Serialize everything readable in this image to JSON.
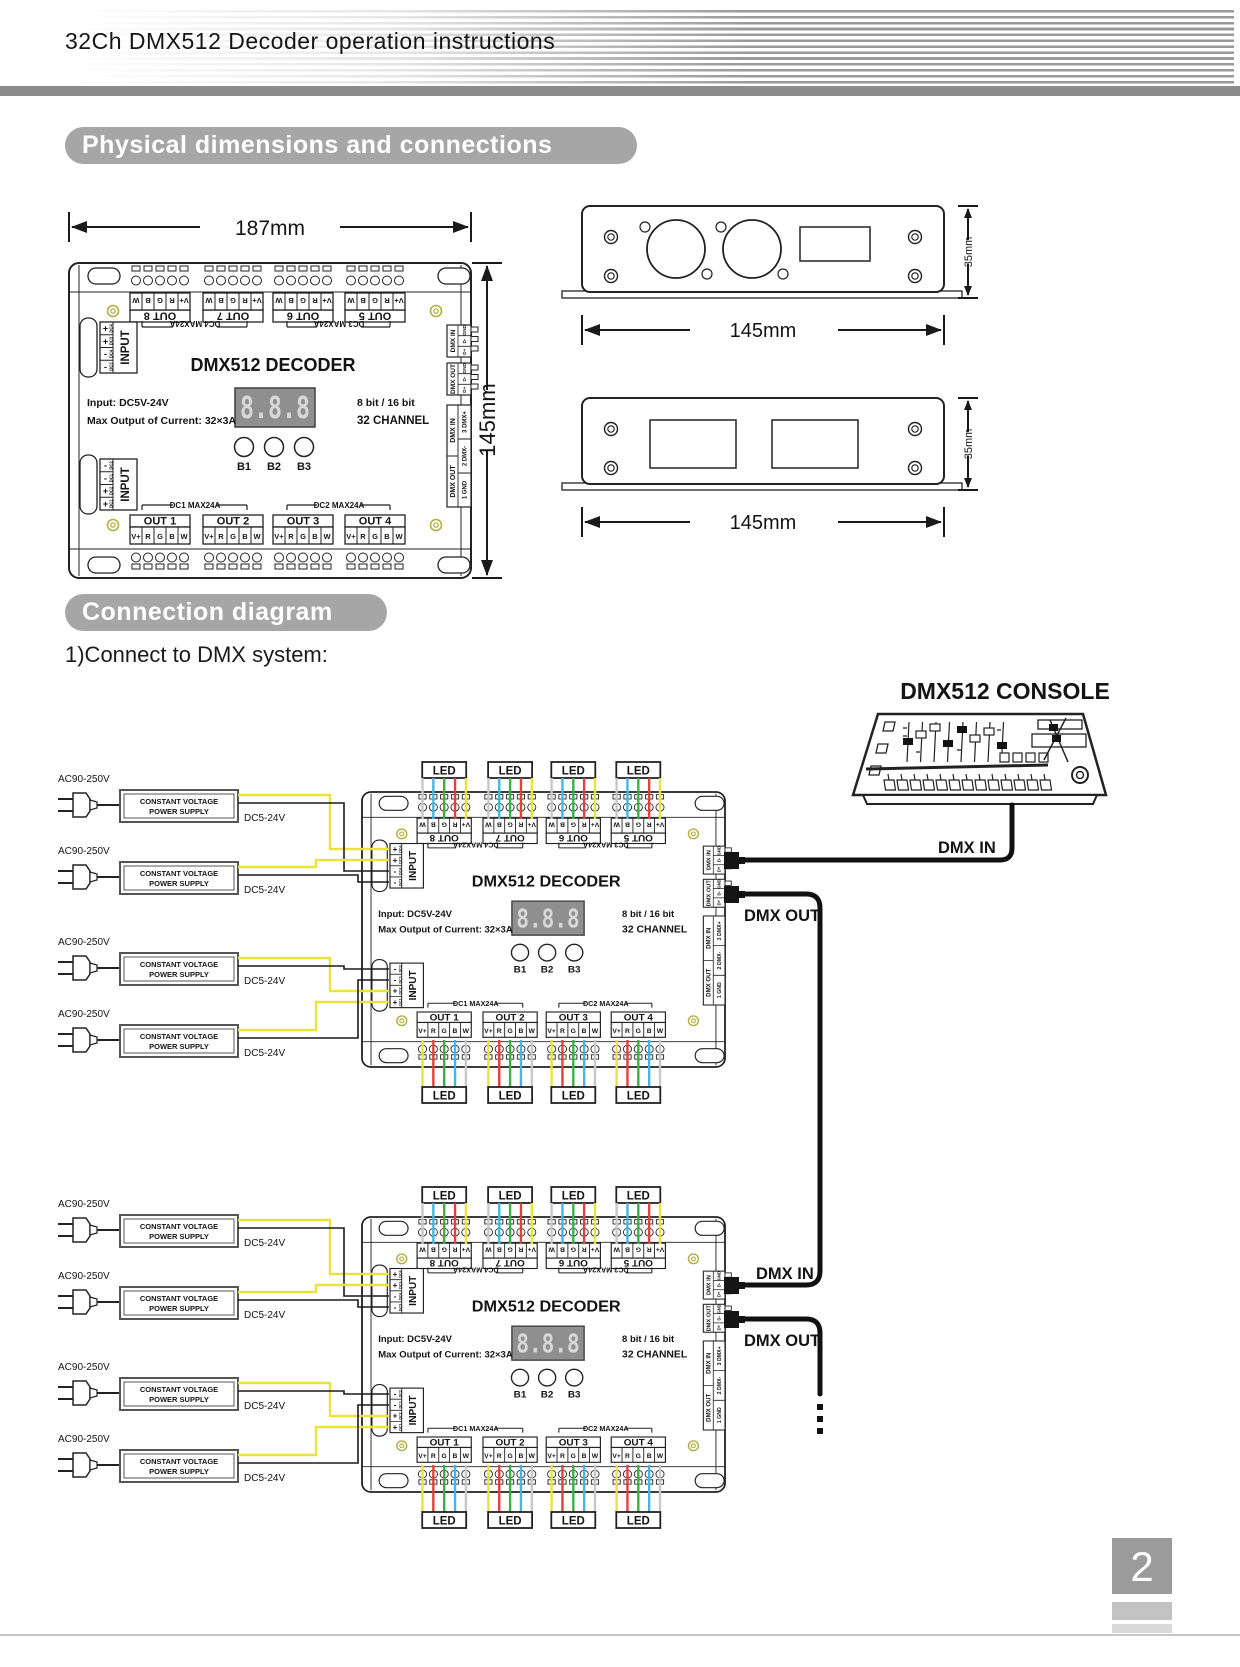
{
  "header": {
    "title": "32Ch DMX512 Decoder operation instructions"
  },
  "sections": {
    "physical": "Physical dimensions and connections",
    "connection": "Connection diagram",
    "step1": "1)Connect to DMX system:"
  },
  "footer": {
    "page_number": "2"
  },
  "dimensions": {
    "width": "187mm",
    "height": "145mm",
    "side_width": "145mm",
    "side_height": "35mm"
  },
  "decoder": {
    "title": "DMX512 DECODER",
    "display_value": "8.8.8",
    "input_spec": "Input: DC5V-24V",
    "output_spec": "Max Output of Current: 32×3A",
    "bit_mode": "8  bit / 16 bit",
    "channel_mode": "32  CHANNEL",
    "buttons": [
      "B1",
      "B2",
      "B3"
    ],
    "outs_top": [
      "OUT 8",
      "OUT 7",
      "OUT 6",
      "OUT 5"
    ],
    "outs_bottom": [
      "OUT 1",
      "OUT 2",
      "OUT 3",
      "OUT 4"
    ],
    "pins": [
      "V+",
      "R",
      "G",
      "B",
      "W"
    ],
    "dc_top": [
      "DC4  MAX24A",
      "DC3  MAX24A"
    ],
    "dc_bottom": [
      "DC1  MAX24A",
      "DC2  MAX24A"
    ],
    "input_label": "INPUT",
    "input_top": {
      "signs": [
        "+",
        "+",
        "-",
        "-"
      ],
      "ids": [
        "DC4",
        "DC3",
        "DC4",
        "DC3"
      ]
    },
    "input_bottom": {
      "signs": [
        "-",
        "-",
        "+",
        "+"
      ],
      "ids": [
        "DC2",
        "DC1",
        "DC2",
        "DC1"
      ]
    },
    "dmx_in": "DMX IN",
    "dmx_out": "DMX OUT",
    "xlr_pins": [
      "GND",
      "D-",
      "D+"
    ],
    "dmx_pins": [
      "3 DMX+",
      "2 DMX-",
      "1 GND"
    ]
  },
  "connection": {
    "console_title": "DMX512 CONSOLE",
    "dmx_in": "DMX IN",
    "dmx_out": "DMX OUT",
    "led": "LED",
    "ac_label": "AC90-250V",
    "dc_label": "DC5-24V",
    "psu_line1": "CONSTANT VOLTAGE",
    "psu_line2": "POWER SUPPLY"
  },
  "colors": {
    "wire_v": "#ece33a",
    "wire_r": "#e4403a",
    "wire_g": "#3fae4a",
    "wire_b": "#45b4e6",
    "wire_w": "#c8c8c8",
    "accent_gray": "#a6a6a6"
  }
}
